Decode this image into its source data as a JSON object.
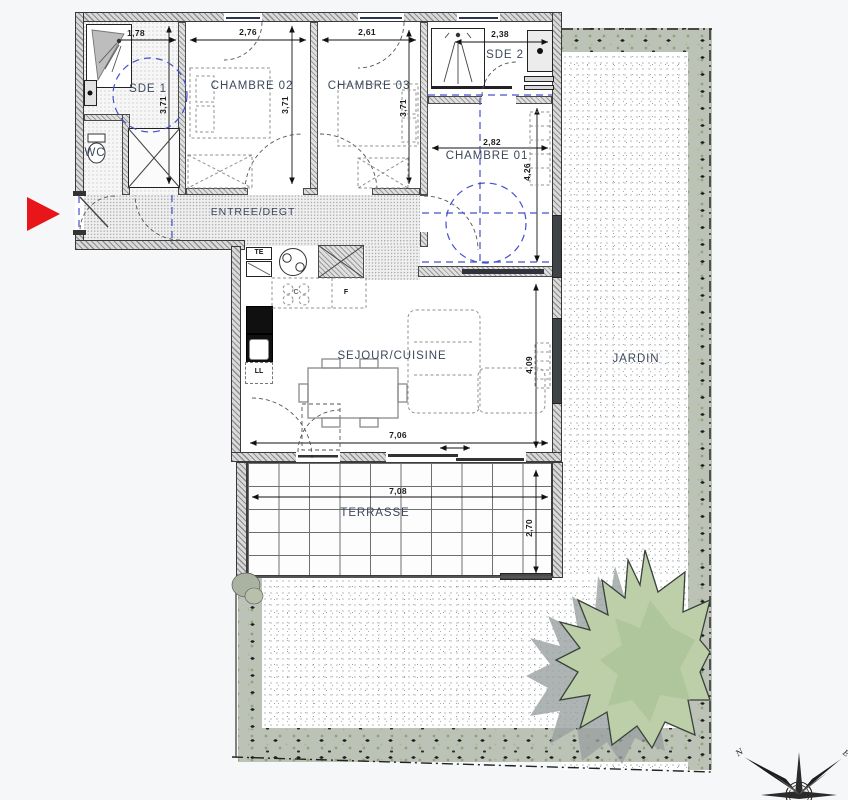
{
  "rooms": {
    "sde1": "SDE 1",
    "wc": "WC",
    "chambre02": "CHAMBRE 02",
    "chambre03": "CHAMBRE 03",
    "sde2": "SDE 2",
    "chambre01": "CHAMBRE 01",
    "entree": "ENTREE/DEGT",
    "sejour": "SEJOUR/CUISINE",
    "terrasse": "TERRASSE",
    "jardin": "JARDIN"
  },
  "dimensions": {
    "sde1_width": "1,78",
    "chambre02_width": "2,76",
    "chambre03_width": "2,61",
    "sde2_width": "2,38",
    "sde1_height": "3,71",
    "chambre02_height": "3,71",
    "chambre03_height": "3,71",
    "chambre01_width": "2,82",
    "chambre01_height": "4,26",
    "sejour_height": "4,09",
    "sejour_width": "7,06",
    "terrasse_width": "7,08",
    "terrasse_height": "2,70"
  },
  "appliances": {
    "electrical_panel": "TE",
    "cooktop": "C",
    "fridge": "F",
    "washer": "LL"
  },
  "compass": {
    "north": "N",
    "east": "E"
  },
  "colors": {
    "entrance_arrow_red": "#e8151b",
    "pmr_circle_blue": "#4450cc",
    "label_blue_gray": "#3c485c",
    "tree_green": "#bccfa8",
    "tree_shadow_gray": "#9aa0a0",
    "garden_band_gray_green": "#bdc2b6",
    "wall_hatch_gray": "#8f8f8f"
  }
}
